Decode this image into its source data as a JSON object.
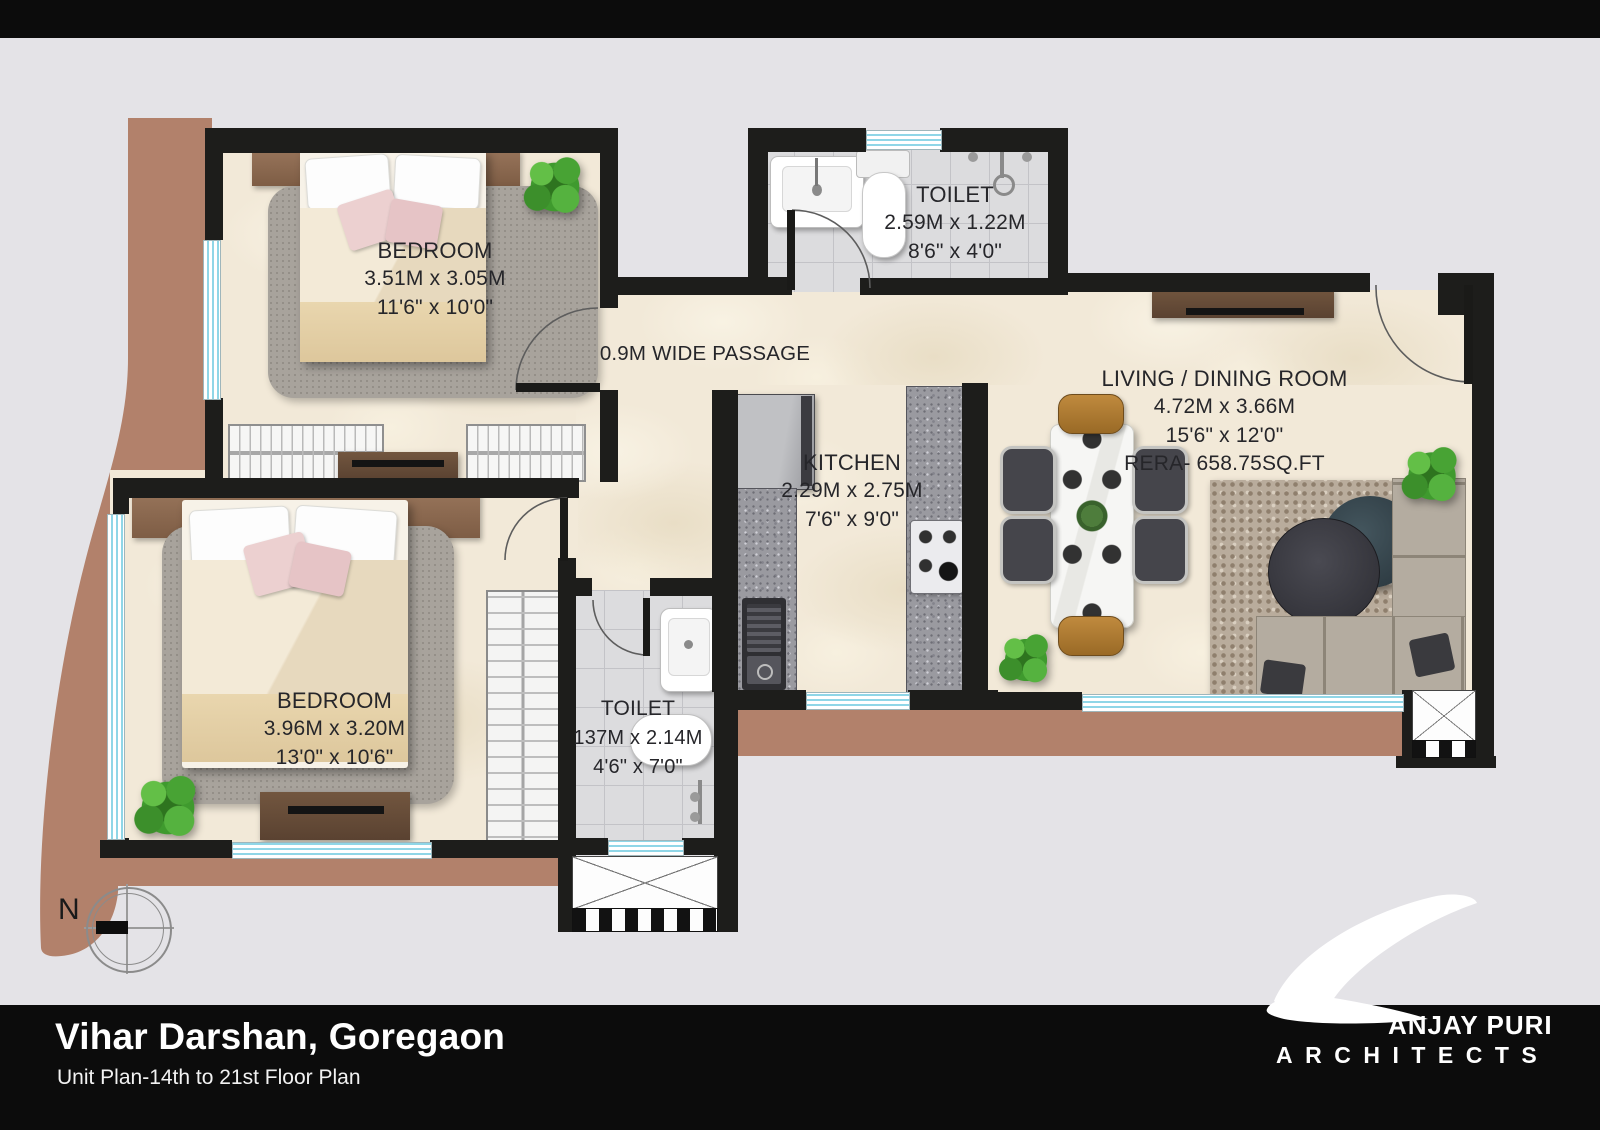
{
  "footer": {
    "title": "Vihar Darshan, Goregaon",
    "subtitle": "Unit Plan-14th to 21st Floor Plan"
  },
  "logo": {
    "brand_rest": "ANJAY PURI",
    "brand_sub": "ARCHITECTS"
  },
  "compass": {
    "north_label": "N"
  },
  "rooms": {
    "bedroom1": {
      "name": "BEDROOM",
      "dim_m": "3.51M x 3.05M",
      "dim_ft": "11'6\" x 10'0\""
    },
    "toilet1": {
      "name": "TOILET",
      "dim_m": "2.59M x 1.22M",
      "dim_ft": "8'6\" x 4'0\""
    },
    "passage": {
      "name": "0.9M WIDE PASSAGE"
    },
    "kitchen": {
      "name": "KITCHEN",
      "dim_m": "2.29M x 2.75M",
      "dim_ft": "7'6\" x 9'0\""
    },
    "living": {
      "name": "LIVING / DINING ROOM",
      "dim_m": "4.72M x 3.66M",
      "dim_ft": "15'6\" x 12'0\"",
      "rera": "RERA- 658.75SQ.FT"
    },
    "bedroom2": {
      "name": "BEDROOM",
      "dim_m": "3.96M x 3.20M",
      "dim_ft": "13'0\" x 10'6\""
    },
    "toilet2": {
      "name": "TOILET",
      "dim_m": "137M x 2.14M",
      "dim_ft": "4'6\" x 7'0\""
    }
  },
  "colors": {
    "wall": "#1d1d1b",
    "terrace_brown": "#b2816b",
    "window_blue": "#8fd6e7",
    "floor_cream": "#f2e9d8",
    "tile_gray": "#dcdcde",
    "footer_black": "#0c0c0c"
  }
}
